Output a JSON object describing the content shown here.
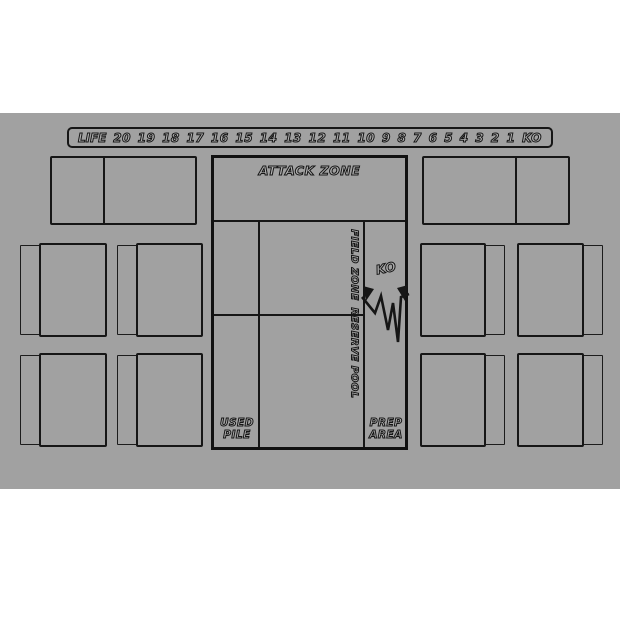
{
  "mat": {
    "background_color": "#a1a1a1",
    "line_color": "#161616",
    "life_track": {
      "label": "LIFE",
      "values": [
        "20",
        "19",
        "18",
        "17",
        "16",
        "15",
        "14",
        "13",
        "12",
        "11",
        "10",
        "9",
        "8",
        "7",
        "6",
        "5",
        "4",
        "3",
        "2",
        "1",
        "KO"
      ]
    },
    "zones": {
      "attack": "ATTACK ZONE",
      "field": "FIELD ZONE",
      "ko": "KO",
      "reserve": "RESERVE POOL",
      "used_pile": {
        "line1": "USED",
        "line2": "PILE"
      },
      "prep_area": {
        "line1": "PREP",
        "line2": "AREA"
      }
    }
  }
}
